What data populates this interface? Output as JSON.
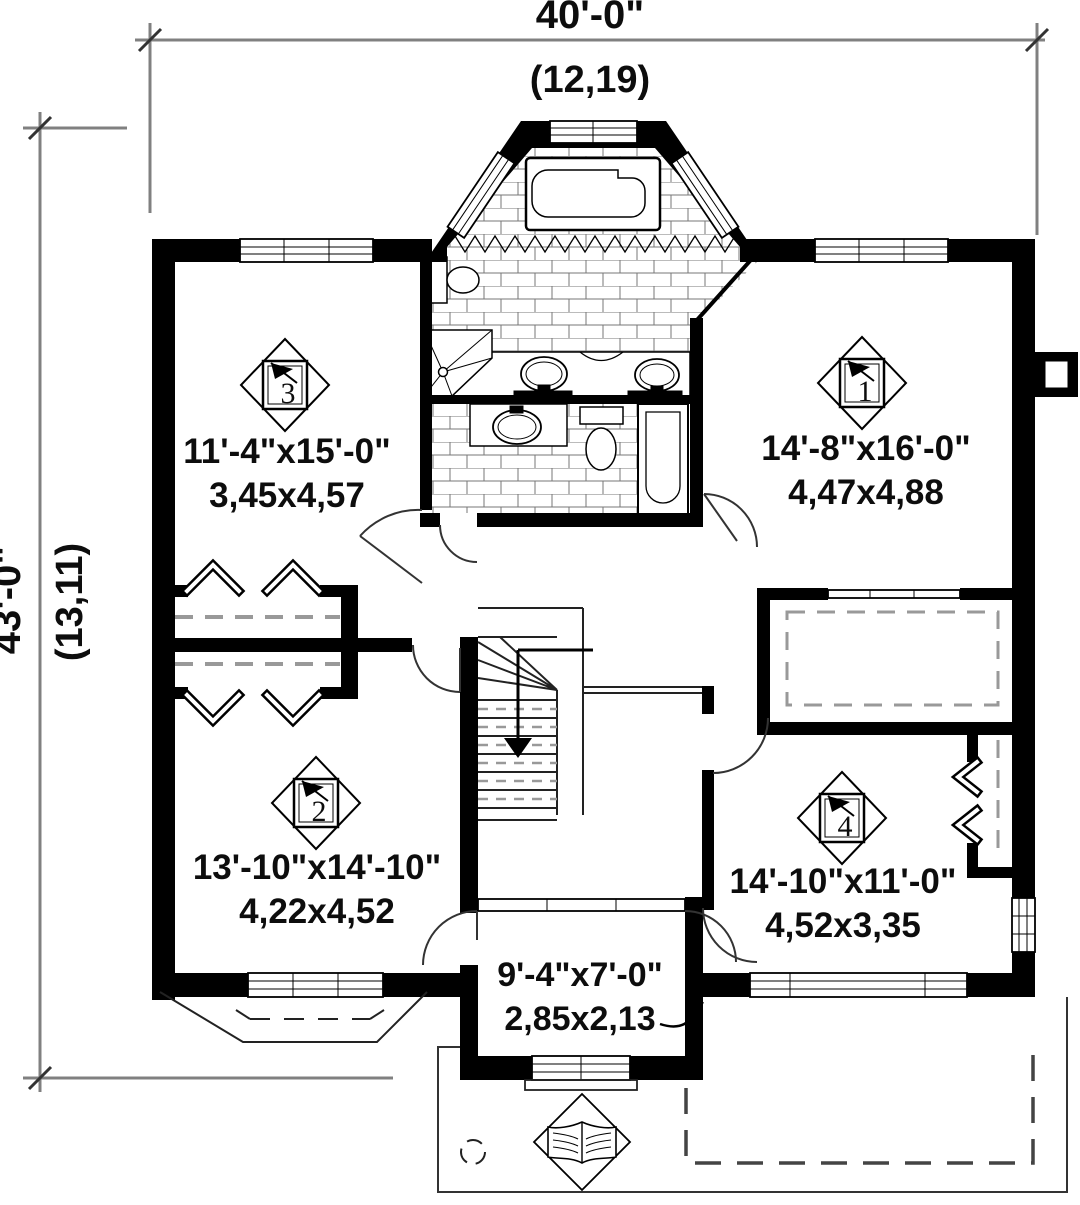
{
  "plan": {
    "overall_width": {
      "imperial": "40'-0\"",
      "metric": "(12,19)"
    },
    "overall_depth": {
      "imperial": "43'-0\"",
      "metric": "(13,11)"
    },
    "rooms": [
      {
        "marker": "1",
        "imperial": "14'-8\"x16'-0\"",
        "metric": "4,47x4,88"
      },
      {
        "marker": "2",
        "imperial": "13'-10\"x14'-10\"",
        "metric": "4,22x4,52"
      },
      {
        "marker": "3",
        "imperial": "11'-4\"x15'-0\"",
        "metric": "3,45x4,57"
      },
      {
        "marker": "4",
        "imperial": "14'-10\"x11'-0\"",
        "metric": "4,52x3,35"
      }
    ],
    "vestibule": {
      "imperial": "9'-4\"x7'-0\"",
      "metric": "2,85x2,13"
    },
    "colors": {
      "wall": "#000000",
      "dimension_line": "#808080",
      "tile_line": "#777777",
      "shelf_dash": "#999999",
      "text": "#0d0d0d",
      "background": "#ffffff"
    }
  }
}
